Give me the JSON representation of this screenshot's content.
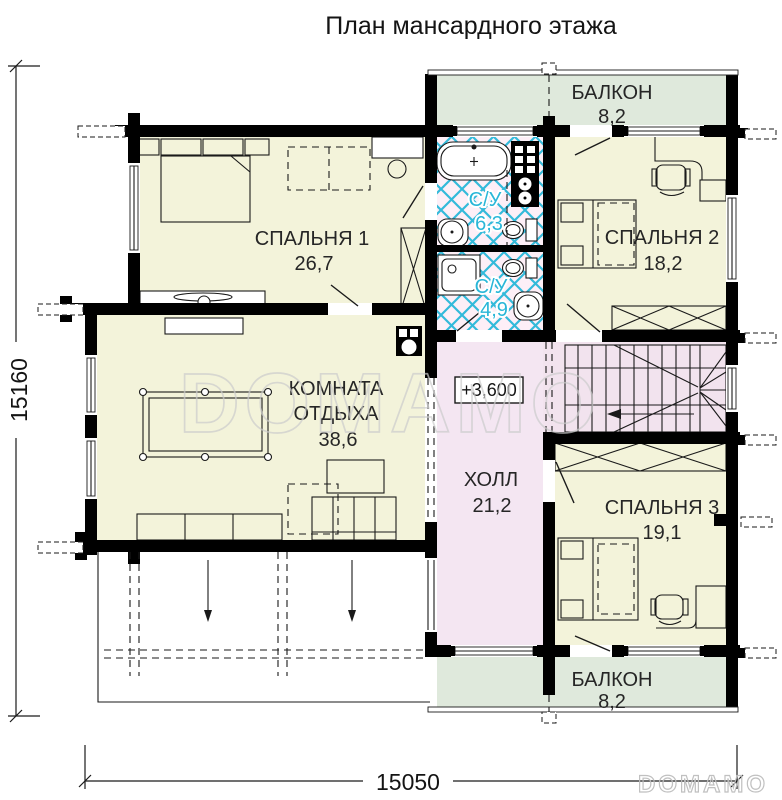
{
  "title": "План мансардного этажа",
  "rooms": {
    "balcony_top": {
      "name": "БАЛКОН",
      "area": "8,2"
    },
    "bedroom1": {
      "name": "СПАЛЬНЯ 1",
      "area": "26,7"
    },
    "bathroom_top": {
      "name": "С/У",
      "area": "6,3"
    },
    "bathroom_bottom": {
      "name": "С/У",
      "area": "4,9"
    },
    "bedroom2": {
      "name": "СПАЛЬНЯ 2",
      "area": "18,2"
    },
    "lounge": {
      "name_line1": "КОМНАТА",
      "name_line2": "ОТДЫХА",
      "area": "38,6"
    },
    "hall": {
      "name": "ХОЛЛ",
      "area": "21,2"
    },
    "bedroom3": {
      "name": "СПАЛЬНЯ 3",
      "area": "19,1"
    },
    "balcony_bottom": {
      "name": "БАЛКОН",
      "area": "8,2"
    }
  },
  "annotations": {
    "level_mark": "+3,600"
  },
  "dimensions": {
    "width_total": "15050",
    "height_total": "15160"
  },
  "watermark": {
    "center": "DOMAMO",
    "corner": "DOMAMO"
  },
  "colors": {
    "room_yellow": "#f3f3da",
    "balcony_green": "#dfe9dc",
    "hall_pink": "#f4e6f2",
    "stair_pink": "#f2e3ee",
    "bath_bg": "#fdeff7",
    "tile_cyan": "#33bada",
    "wall_black": "#000000",
    "label_cyan": "#29b6d8"
  }
}
